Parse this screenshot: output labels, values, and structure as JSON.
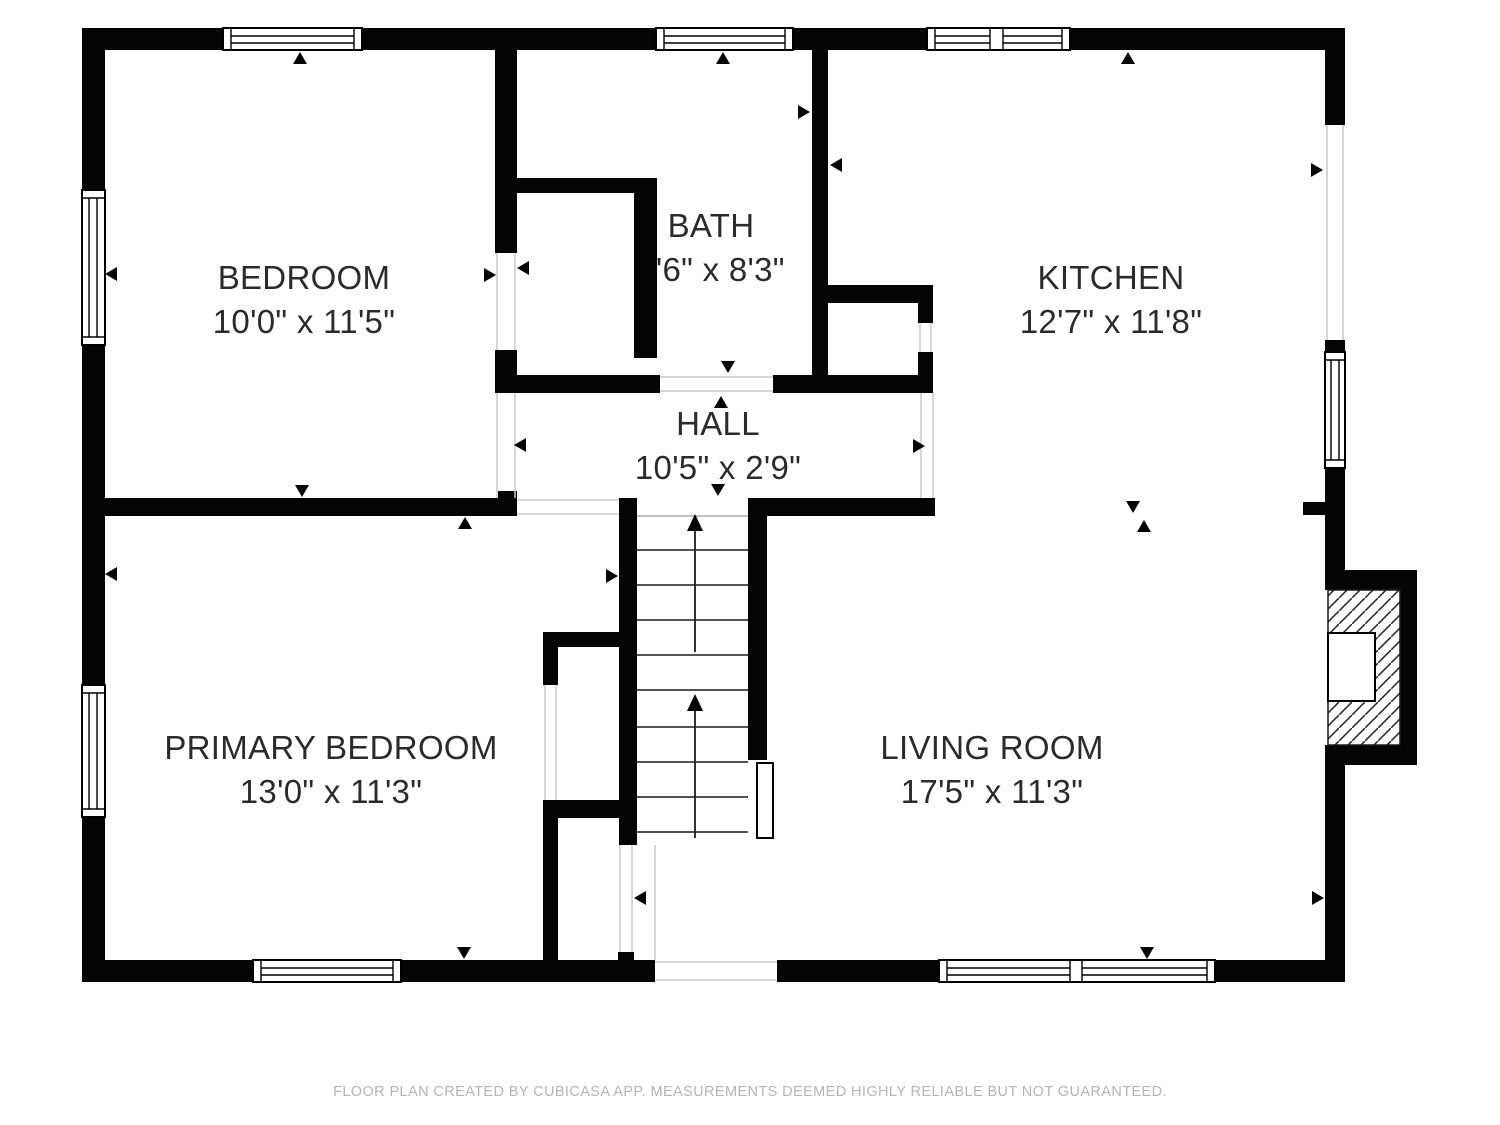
{
  "rooms": {
    "bedroom": {
      "name": "BEDROOM",
      "dims": "10'0\" x 11'5\""
    },
    "bath": {
      "name": "BATH",
      "dims": "7'6\" x 8'3\""
    },
    "kitchen": {
      "name": "KITCHEN",
      "dims": "12'7\" x 11'8\""
    },
    "hall": {
      "name": "HALL",
      "dims": "10'5\" x 2'9\""
    },
    "primary_bedroom": {
      "name": "PRIMARY BEDROOM",
      "dims": "13'0\" x 11'3\""
    },
    "living_room": {
      "name": "LIVING ROOM",
      "dims": "17'5\" x 11'3\""
    }
  },
  "footer": {
    "disclaimer": "FLOOR PLAN CREATED BY CUBICASA APP. MEASUREMENTS DEEMED HIGHLY RELIABLE BUT NOT GUARANTEED."
  },
  "colors": {
    "wall": "#000000",
    "background": "#ffffff",
    "room_text": "#2b2b2b",
    "footer_text": "#b5b5b5"
  }
}
